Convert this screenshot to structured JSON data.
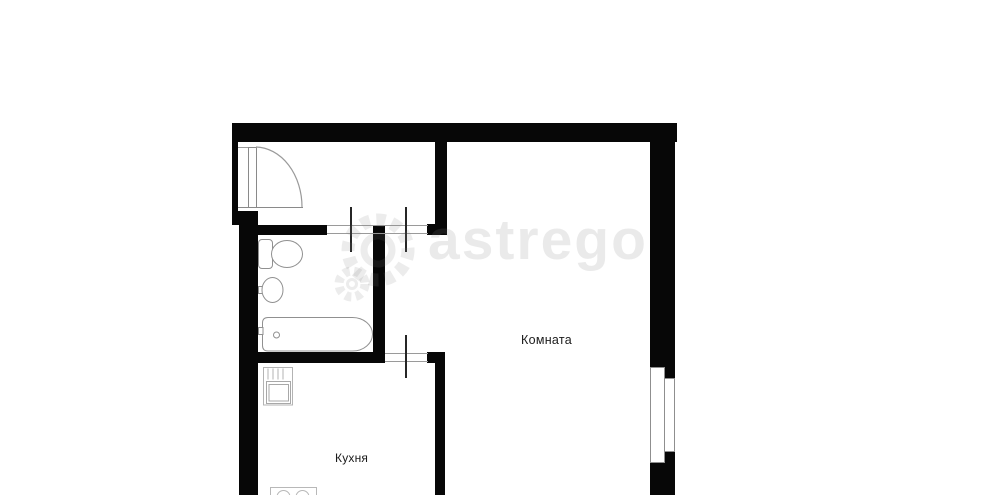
{
  "image": {
    "type": "apartment-floor-plan",
    "background": "#ffffff"
  },
  "rooms": [
    {
      "id": "room",
      "label": "Комната"
    },
    {
      "id": "kitchen",
      "label": "Кухня"
    }
  ],
  "fixtures": [
    "entrance-door",
    "toilet",
    "wash-basin",
    "bathtub",
    "kitchen-sink-unit",
    "stove",
    "window"
  ],
  "watermark": {
    "logo": "gear-icon",
    "text": "astrego",
    "color": "rgba(128,128,128,0.17)"
  },
  "colors": {
    "walls": "#070707",
    "fixture_outline": "#909090",
    "opening_line": "#9a9a9a",
    "label_text": "#1b1b1b"
  }
}
